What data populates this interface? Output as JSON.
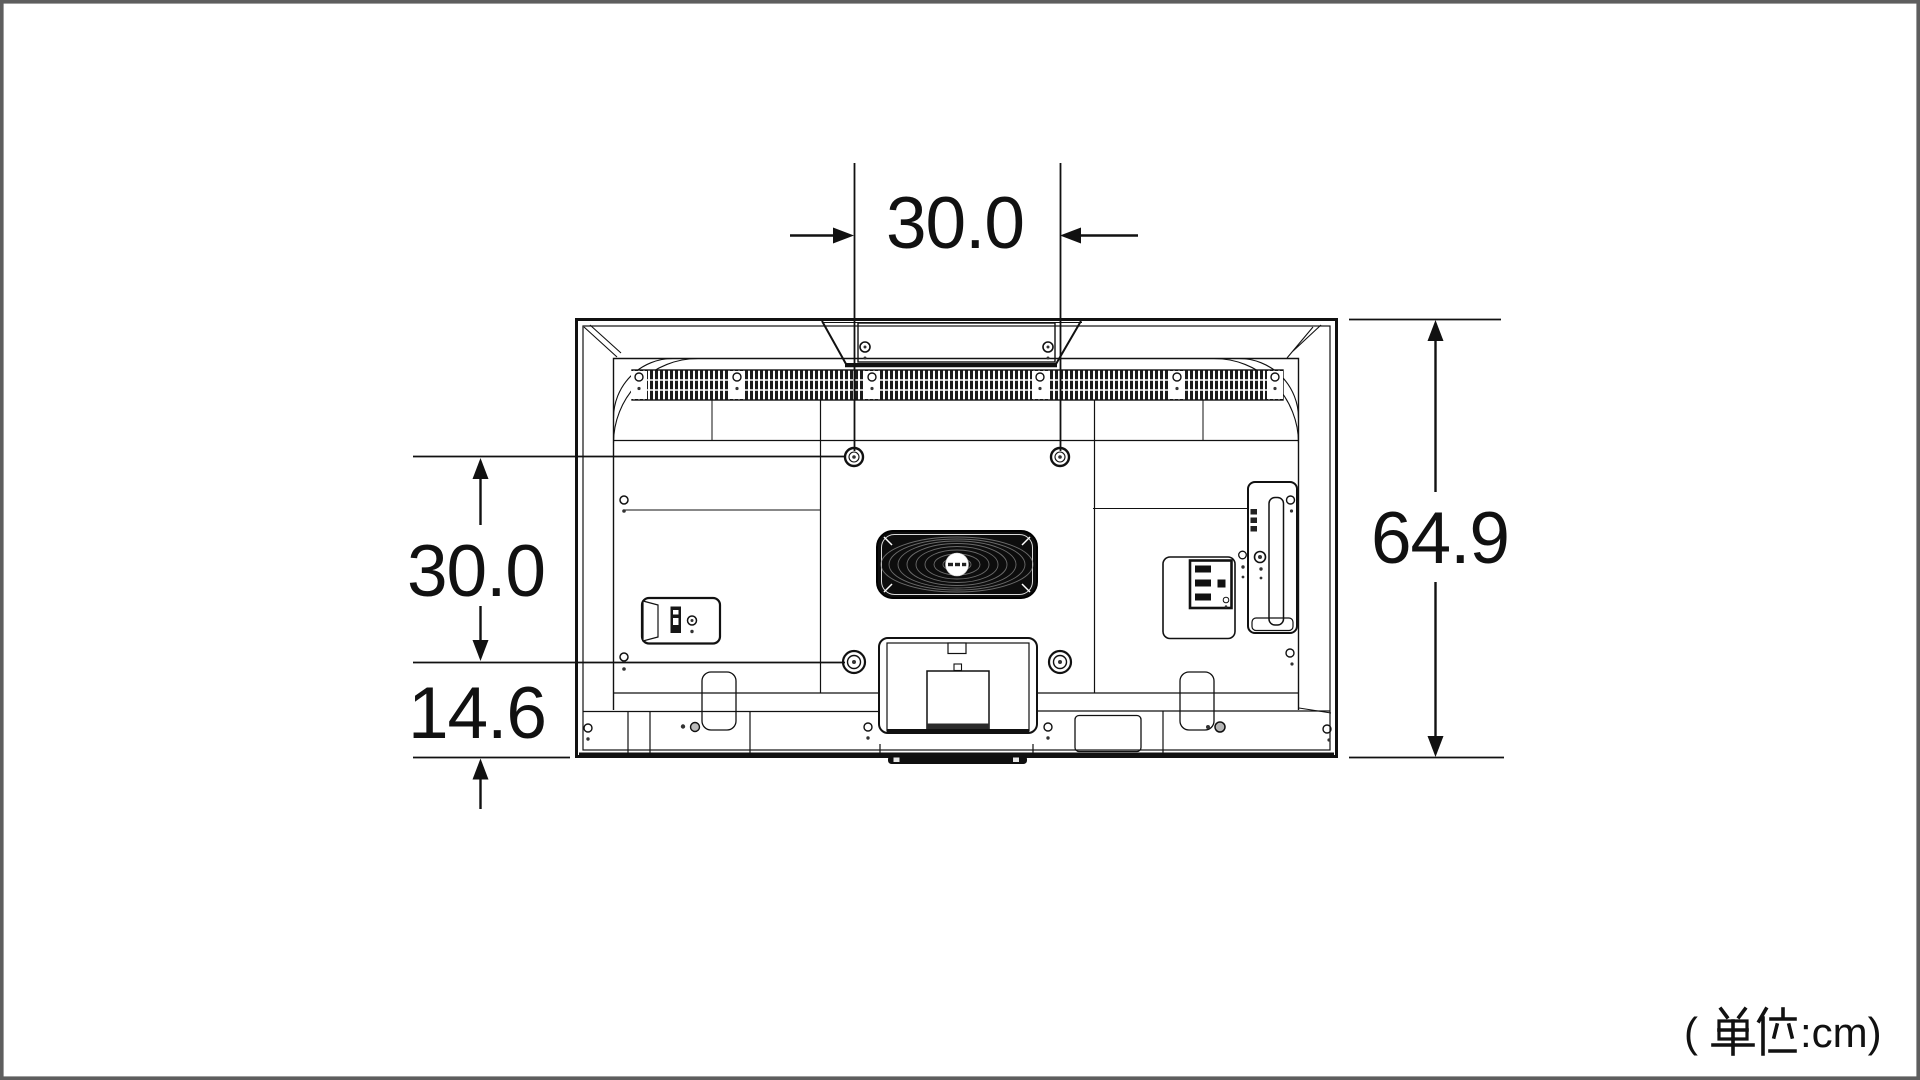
{
  "colors": {
    "background": "#ffffff",
    "line": "#111111",
    "canvas_border": "#5e5e5e"
  },
  "dimensions": {
    "top_width": "30.0",
    "vesa_vertical": "30.0",
    "bottom_offset": "14.6",
    "overall_height": "64.9"
  },
  "unit": {
    "label": "(単位:cm)",
    "open": "(",
    "close": ":cm)"
  }
}
